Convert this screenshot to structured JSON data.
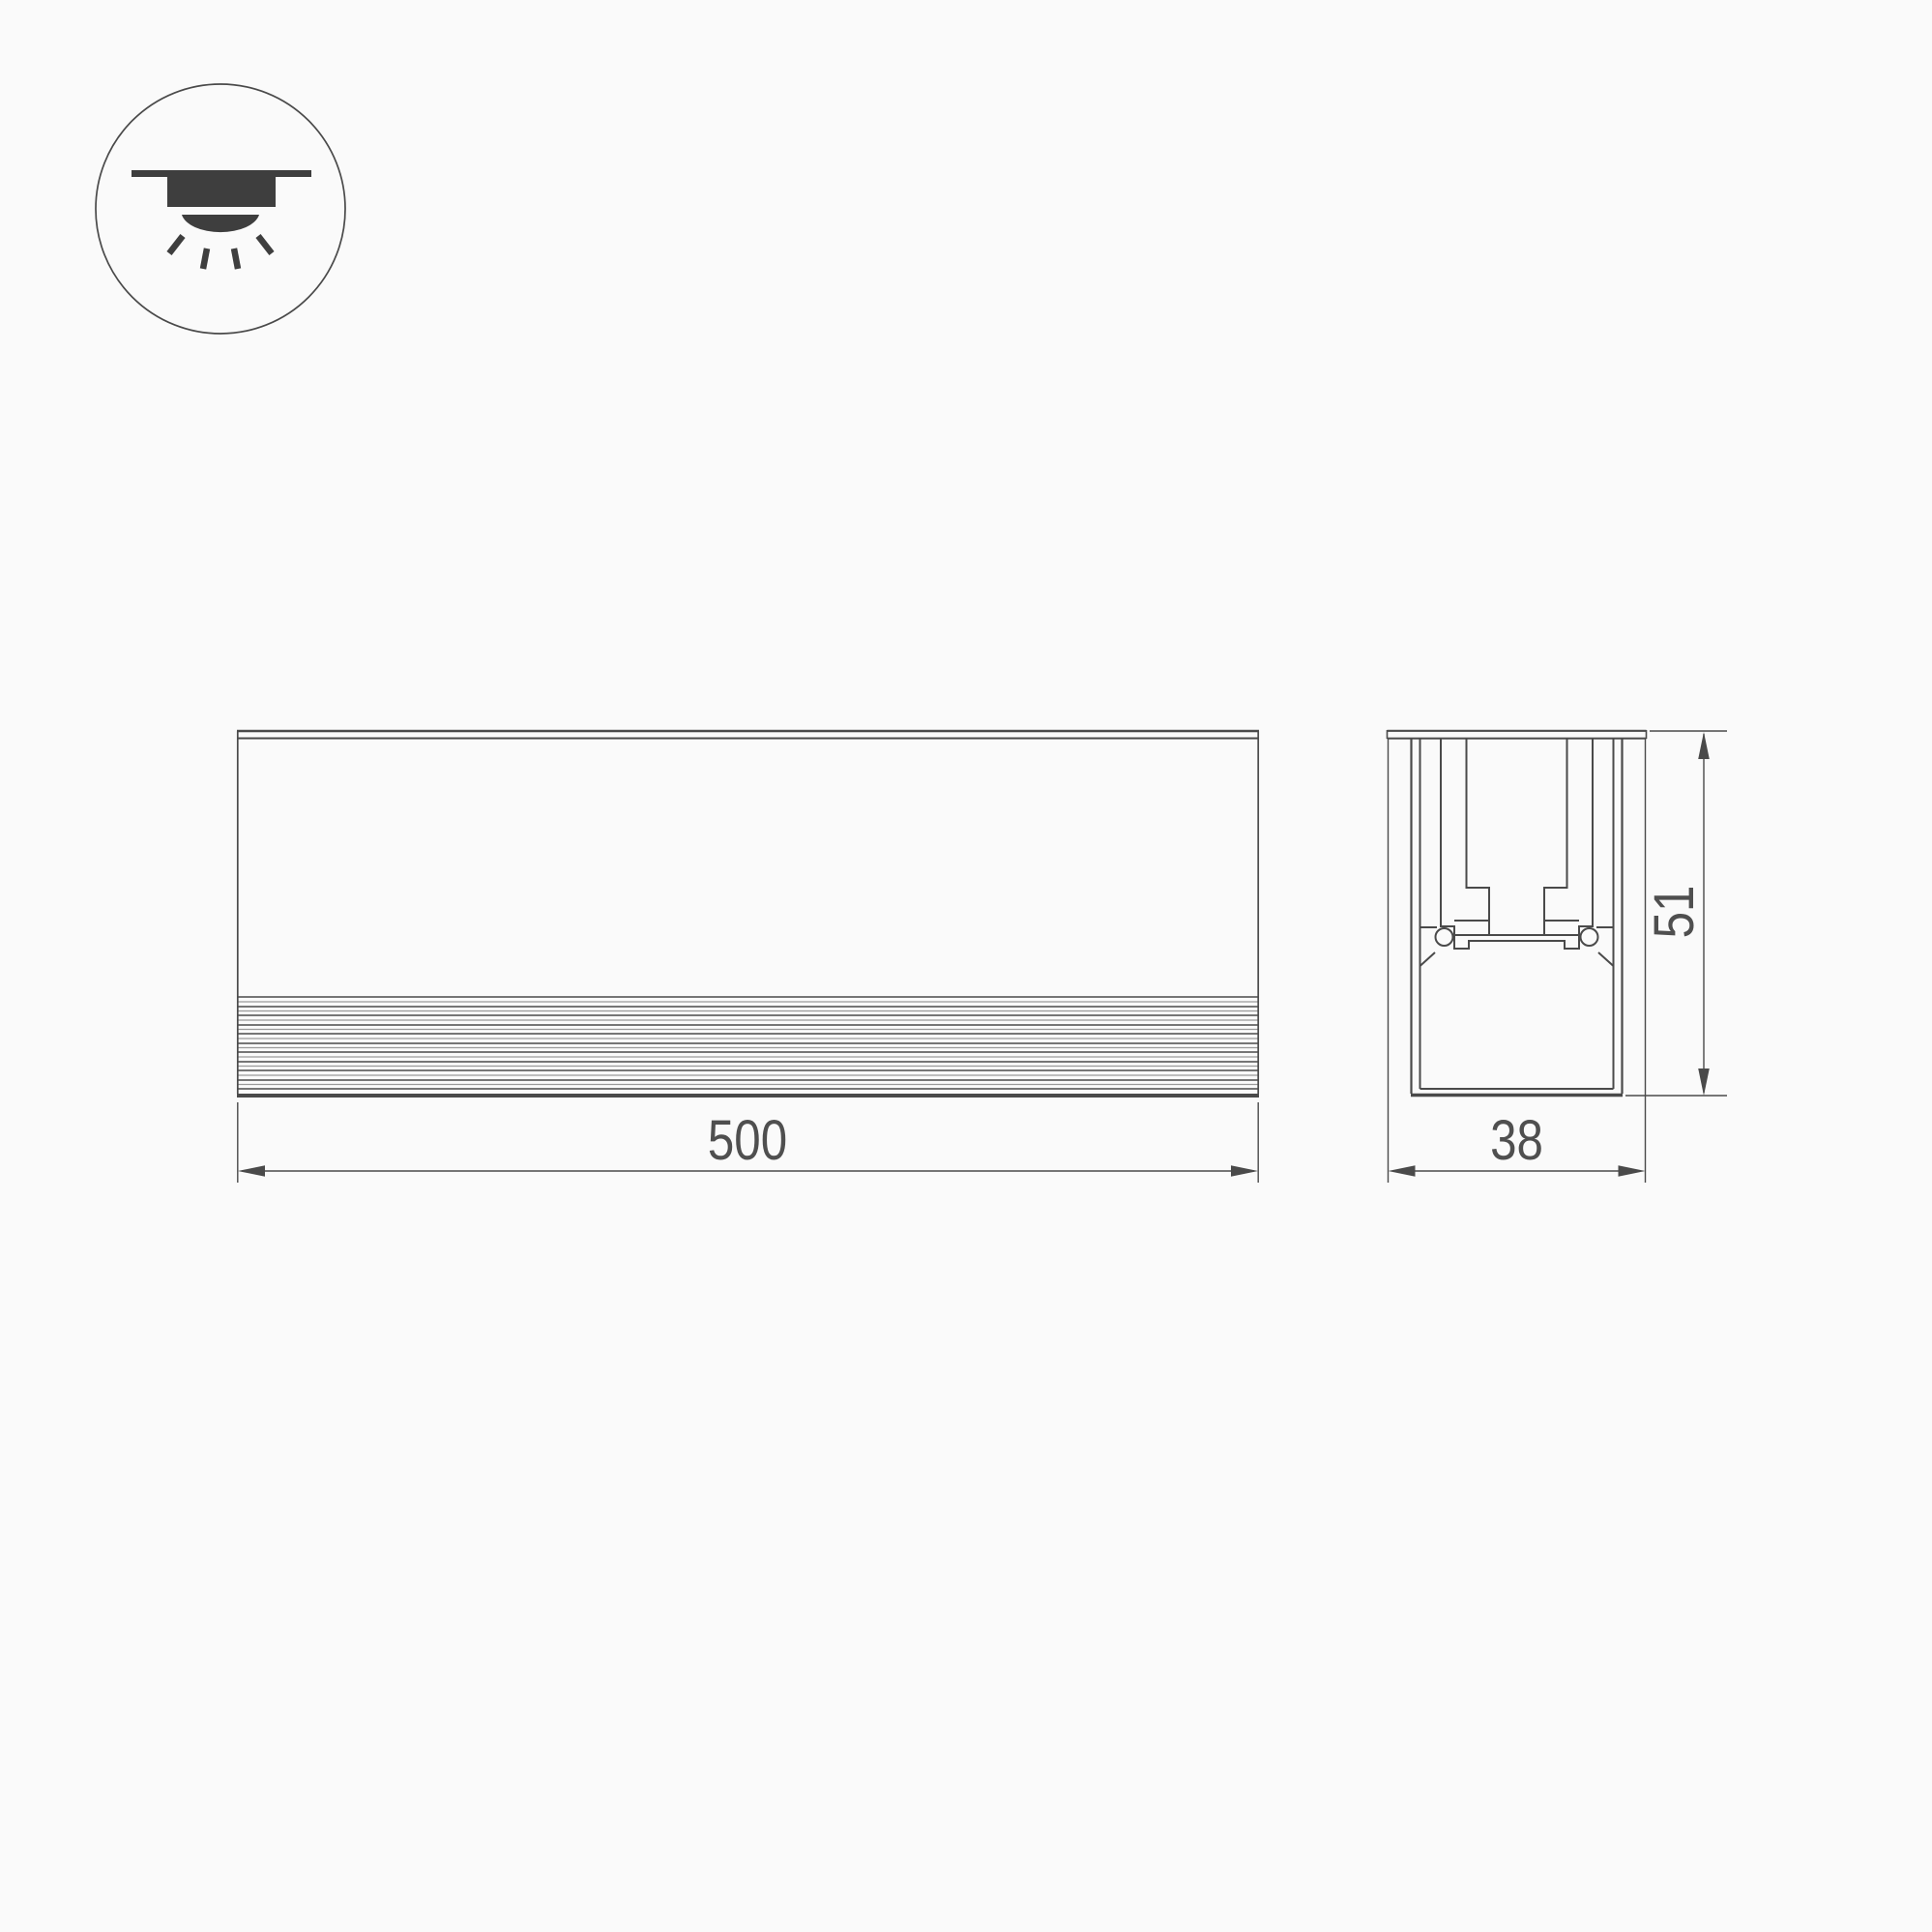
{
  "page": {
    "background_color": "#fafafa",
    "line_color": "#4a4a4a",
    "icon_color": "#3e3e3e",
    "dimension_text_color": "#4f4f4f"
  },
  "mounting_icon": {
    "name": "recessed-downlight"
  },
  "views": {
    "front": {
      "dimensions": {
        "length": "500"
      }
    },
    "section": {
      "dimensions": {
        "width": "38",
        "height": "51"
      }
    }
  }
}
